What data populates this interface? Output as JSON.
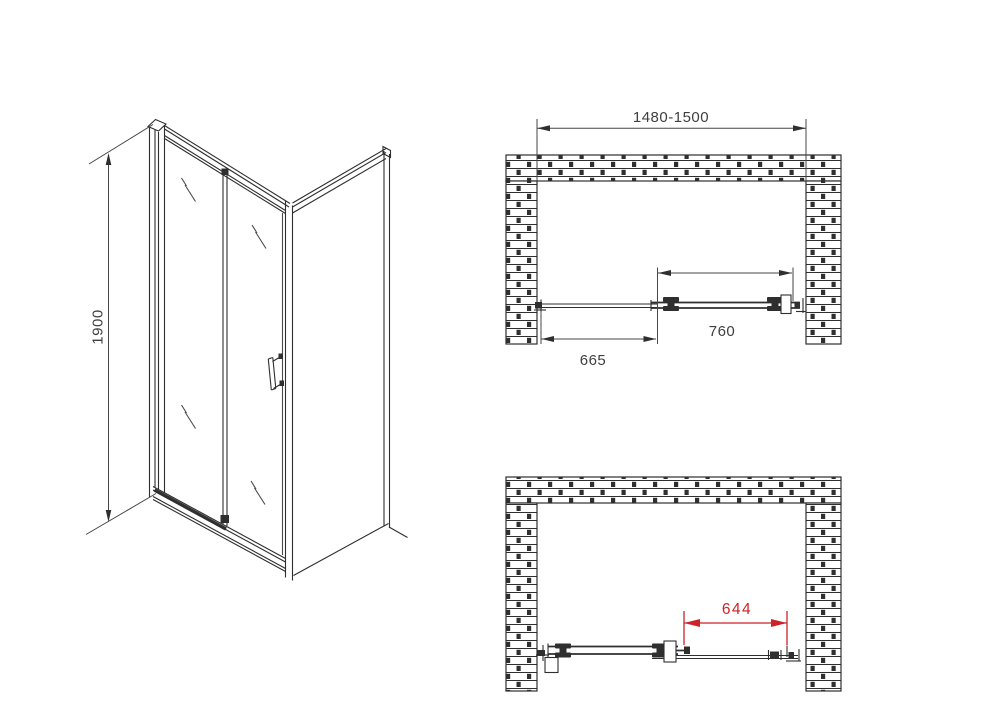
{
  "views": {
    "isometric": {
      "height_label": "1900"
    },
    "plan_closed": {
      "overall_width_label": "1480-1500",
      "door_width_label": "760",
      "fixed_panel_label": "665"
    },
    "plan_open": {
      "opening_width_label": "644"
    }
  },
  "colors": {
    "line": "#2e2e2e",
    "dimension_text": "#3f3f3f",
    "accent_red": "#cc2228",
    "background": "#ffffff"
  }
}
